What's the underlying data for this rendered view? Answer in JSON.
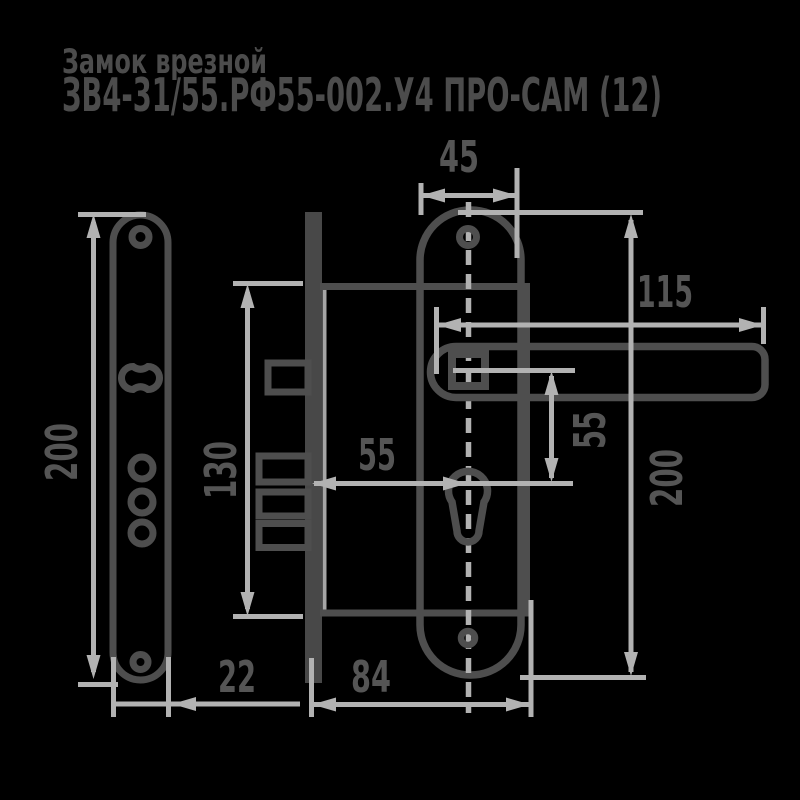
{
  "title": {
    "line1": "Замок врезной",
    "line2": "ЗВ4-31/55.РФ55-002.У4 ПРО-САМ (12)"
  },
  "drawing": {
    "type": "technical-drawing",
    "subject": "mortise lock with escutcheon plates and lever handle",
    "views": [
      "interior-plate-front",
      "lock-body-side",
      "exterior-plate-with-handle"
    ]
  },
  "dimensions": {
    "left_plate_height": {
      "value": "200",
      "meaning": "interior plate height, mm"
    },
    "left_plate_width": {
      "value": "22",
      "meaning": "interior plate width, mm"
    },
    "body_height": {
      "value": "130",
      "meaning": "lock body height, mm"
    },
    "backset": {
      "value": "55",
      "meaning": "faceplate to cylinder axis, mm"
    },
    "body_depth": {
      "value": "84",
      "meaning": "lock body depth, mm"
    },
    "right_plate_width": {
      "value": "45",
      "meaning": "exterior plate width, mm"
    },
    "handle_length": {
      "value": "115",
      "meaning": "lever handle length, mm"
    },
    "handle_to_cylinder": {
      "value": "55",
      "meaning": "handle axis to cylinder axis, mm"
    },
    "right_plate_height": {
      "value": "200",
      "meaning": "exterior plate height, mm"
    }
  },
  "colors": {
    "background": "#000000",
    "outline_ink": "#4e4e4e",
    "dimension_lines": "#b2b2b2",
    "label_text": "#555555",
    "title_text": "#4c4c4c"
  }
}
